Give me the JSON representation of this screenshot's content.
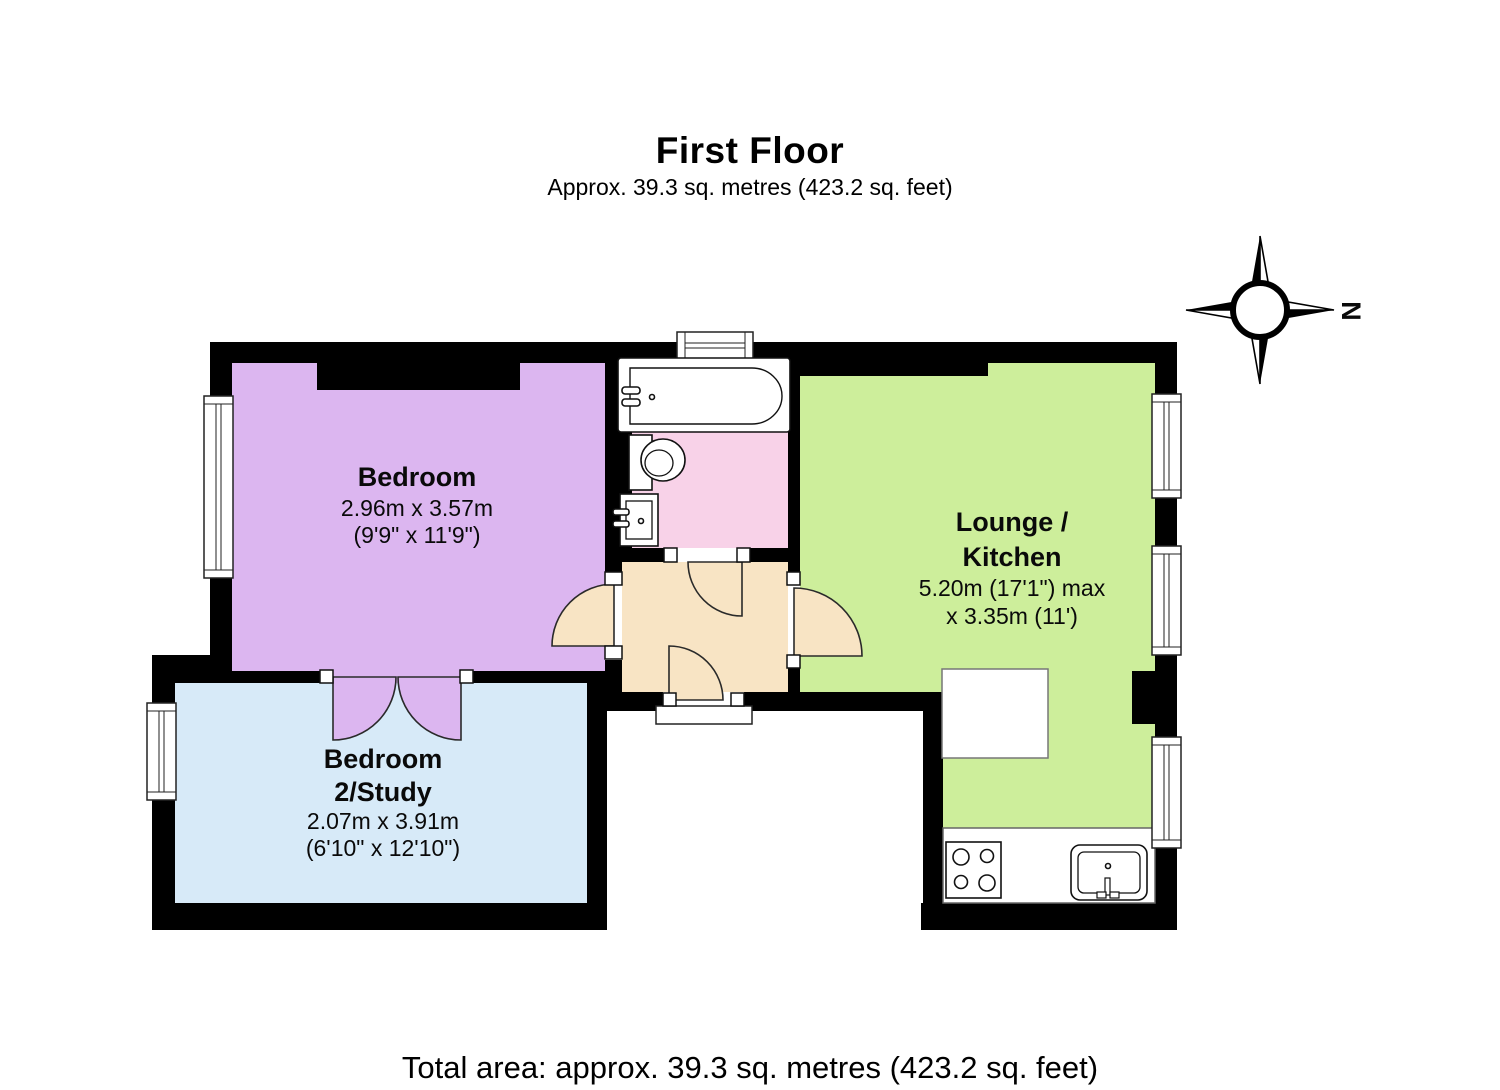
{
  "page": {
    "title": "First Floor",
    "subtitle": "Approx.  39.3 sq. metres (423.2 sq. feet)",
    "footer": "Total area: approx.  39.3 sq. metres (423.2 sq. feet)"
  },
  "compass": {
    "north_label": "N"
  },
  "colors": {
    "walls": "#000000",
    "fixtures": "#ffffff"
  },
  "rooms": {
    "bedroom": {
      "name": "Bedroom",
      "dims_metric": "2.96m x 3.57m",
      "dims_imperial": "(9'9\" x 11'9\")",
      "color": "#dcb6f0"
    },
    "bedroom2_study": {
      "name_line1": "Bedroom",
      "name_line2": "2/Study",
      "dims_metric": "2.07m x 3.91m",
      "dims_imperial": "(6'10\" x 12'10\")",
      "color": "#d7eaf8"
    },
    "lounge_kitchen": {
      "name_line1": "Lounge /",
      "name_line2": "Kitchen",
      "dims_metric": "5.20m (17'1\") max",
      "dims_imperial": "x 3.35m (11')",
      "color": "#cdee9b"
    },
    "bathroom": {
      "color": "#f8d2e8"
    },
    "hallway": {
      "color": "#f8e4c4"
    }
  }
}
